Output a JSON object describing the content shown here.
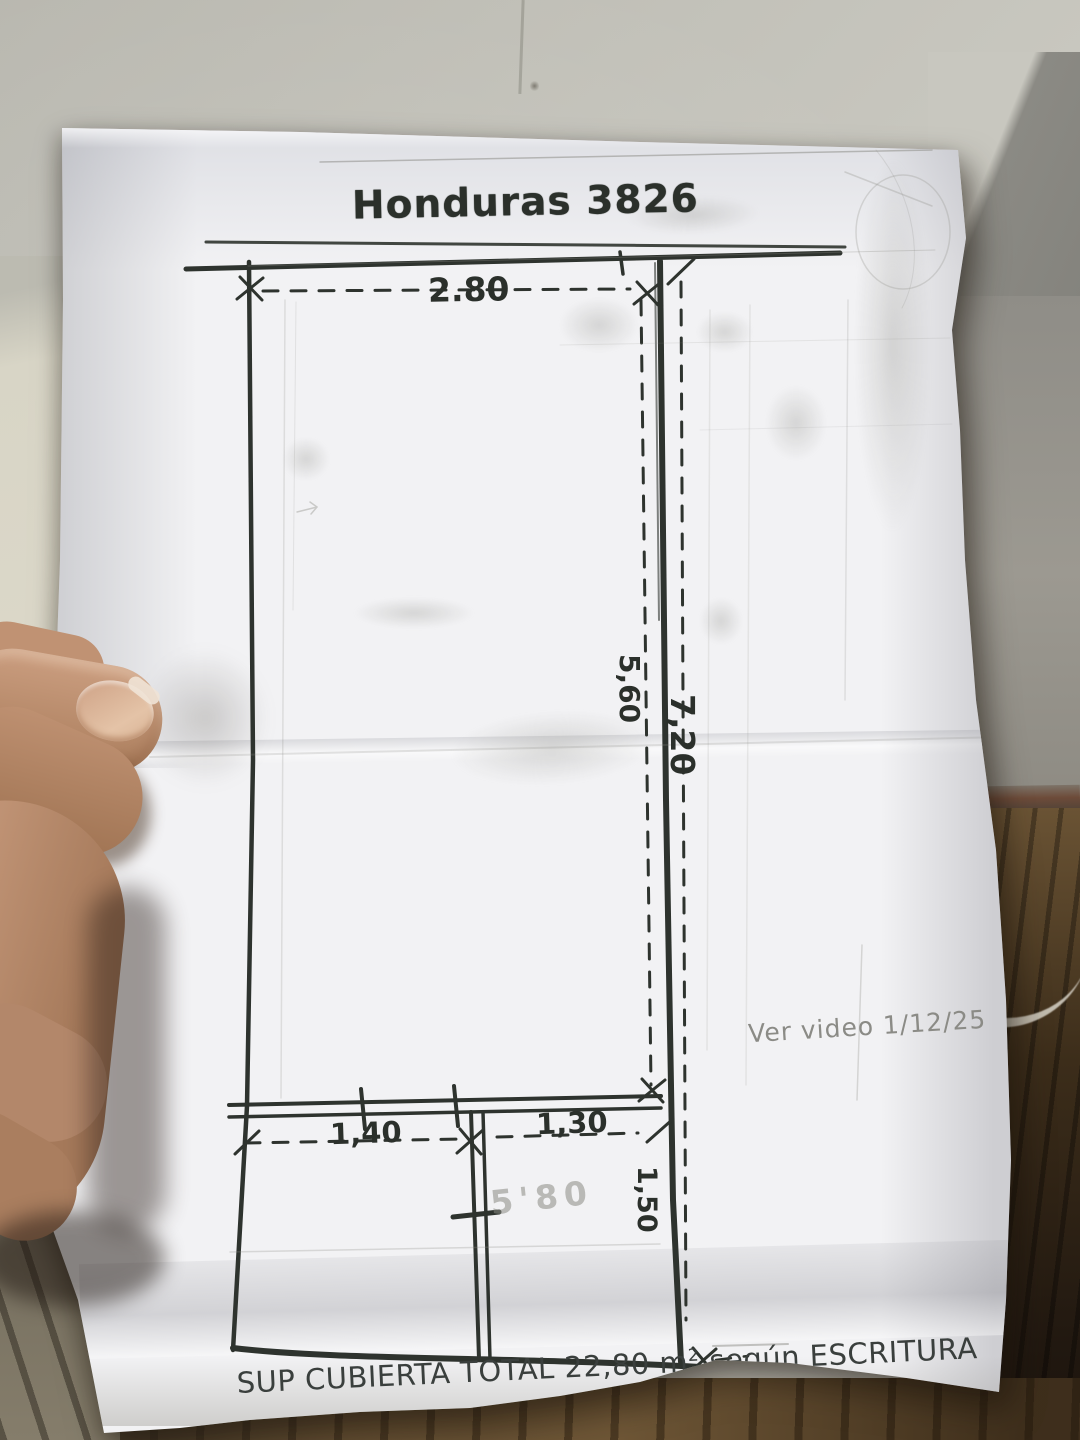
{
  "photo": {
    "paper": {
      "title": "Honduras 3826",
      "floor_plan": {
        "width_top": "2.80",
        "height_inner": "5,60",
        "height_total": "7,20",
        "width_bottom_left": "1,40",
        "width_bottom_right": "1,30",
        "height_bottom_right": "1,50",
        "area_pencil": "5'80"
      },
      "note_pencil": "Ver video 1/12/25",
      "footer": {
        "text": "SUP CUBIERTA TOTAL 22,80 m",
        "superscript": "2",
        "suffix": "según ESCRITURA"
      }
    },
    "colors": {
      "ink": "#2b302b",
      "pencil": "#8b8b86",
      "paper": "#f2f2f4",
      "wall": "#c8c7bf",
      "wall_right": "#908e88",
      "wood_floor": "#6e5636",
      "skin": "#b98e72"
    }
  }
}
